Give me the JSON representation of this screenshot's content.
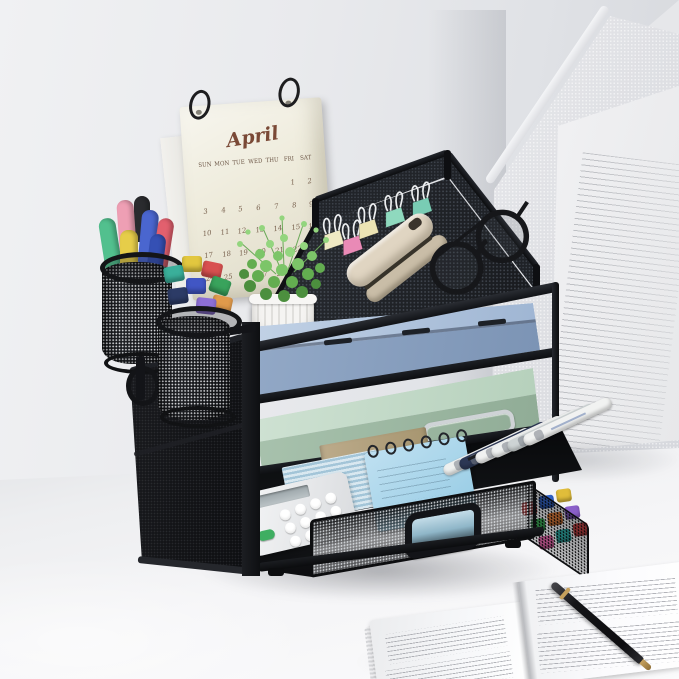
{
  "scene": {
    "type": "product-photo",
    "subject": "4-tier black mesh desk organizer with sliding drawer on a white desk",
    "wall_color": "#e8e9ec",
    "desk_color": "#f5f5f7"
  },
  "calendar": {
    "month": "April",
    "day_headers": [
      "SUN",
      "MON",
      "TUE",
      "WED",
      "THU",
      "FRI",
      "SAT"
    ],
    "weeks": [
      [
        "",
        "",
        "",
        "",
        "",
        "1",
        "2"
      ],
      [
        "3",
        "4",
        "5",
        "6",
        "7",
        "8",
        "9"
      ],
      [
        "10",
        "11",
        "12",
        "13",
        "14",
        "15",
        "16"
      ],
      [
        "17",
        "18",
        "19",
        "20",
        "21",
        "22",
        "23"
      ],
      [
        "24",
        "25",
        "26",
        "27",
        "28",
        "29",
        "30"
      ]
    ],
    "paper_color": "#eeebdb",
    "ink_color": "#7a4936"
  },
  "organizer": {
    "frame_color": "#141619",
    "mesh_dot_color": "#3c4046",
    "tray2_folder_color": "#a9bfd9",
    "tray3_folder_color": "#c2dac7",
    "tiers": [
      {
        "id": "top-tray",
        "items": [
          "binder clips",
          "stapler",
          "eyeglasses",
          "potted plant"
        ]
      },
      {
        "id": "tray-2",
        "item": "blue document folder"
      },
      {
        "id": "tray-3",
        "item": "mint document folder with metal handle"
      },
      {
        "id": "drawer",
        "items": [
          "calculator",
          "kraft envelope",
          "striped paper",
          "blue spiral notebook",
          "white markers",
          "colored marker caps"
        ]
      }
    ]
  },
  "pen_cups": {
    "cup1_marker_colors": [
      "#2a2b2e",
      "#ee9fb4",
      "#52c08e",
      "#4a66cf",
      "#e2606e",
      "#e6cd49",
      "#3550b4"
    ],
    "cup2_marker_colors": [
      "#e2c73f",
      "#d85050",
      "#3aaf9a",
      "#39a35c",
      "#4156c4",
      "#e09a4b",
      "#8d6fd6",
      "#2c3b66"
    ]
  },
  "top_items": {
    "binder_clip_colors": [
      "#efe9c4",
      "#e98ab6",
      "#ebe3b4",
      "#8fd9be",
      "#79ccb4"
    ],
    "stapler_color": "#e0d5c2",
    "glasses_color": "#16171a",
    "pot_color": "#f1f0ee",
    "plant_foliage_colors": [
      "#4c8f3e",
      "#63ad50",
      "#7cc568",
      "#93d57e"
    ]
  },
  "drawer_contents": {
    "calculator_color": "#eef0f2",
    "calculator_green_key": "#3fae62",
    "notebook_color": "#a5d2e8",
    "envelope_color": "#b3a283",
    "white_marker_colors": [
      "#eef0ef",
      "#2c3754",
      "#f1f2f1",
      "#eef0ef",
      "#cdd3d4",
      "#f1f2f1"
    ],
    "cap_colors": [
      "#cf4040",
      "#2f62c9",
      "#e0bd3a",
      "#35a14d",
      "#e07a35",
      "#8a5fc9",
      "#d95fa0",
      "#2aa6a0",
      "#c94040"
    ]
  },
  "background_objects": {
    "magazine_holder_color": "#e2e3e6",
    "document_color": "#f1f1f3"
  },
  "book": {
    "page_color": "#f6f6f8",
    "pen_color": "#141417",
    "pen_accent": "#c5a05c"
  }
}
